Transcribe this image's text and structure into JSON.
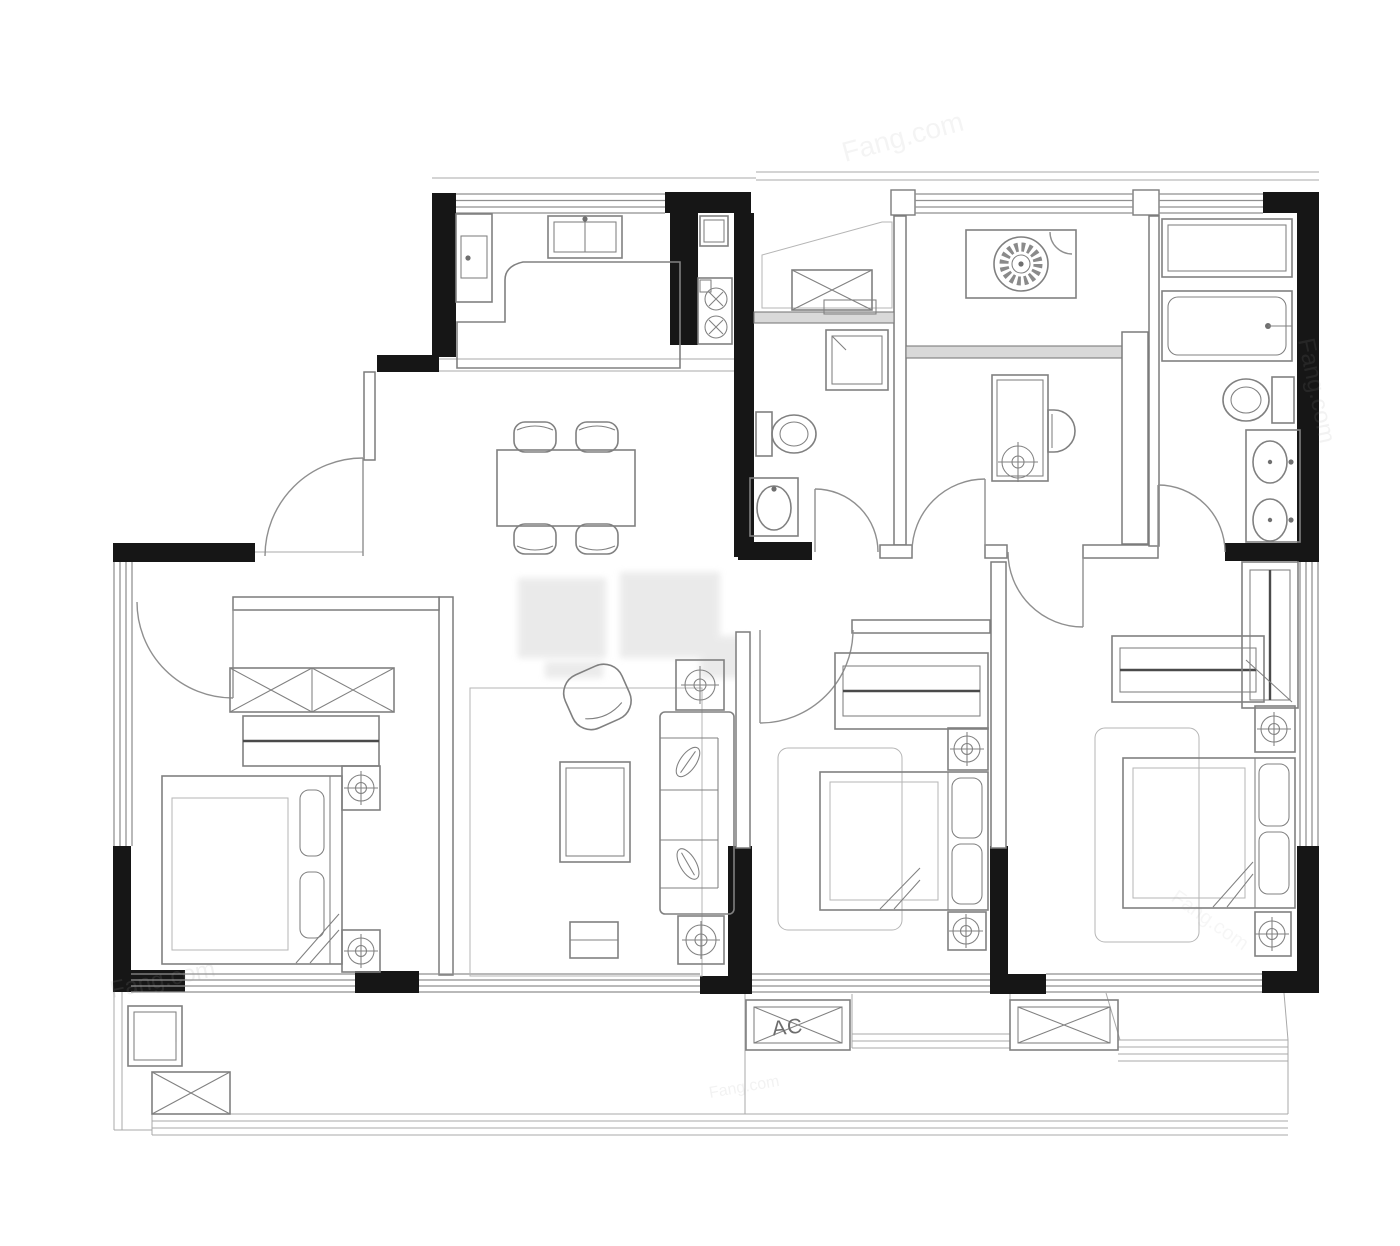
{
  "plan": {
    "ac_label": "AC",
    "watermark_text": "Fang.com",
    "colors": {
      "wall": "#161616",
      "line": "#7c7c7c",
      "furniture": "#808080",
      "window": "#8f8f8f",
      "band": "#d9d9d9",
      "watermark": "#9b9b9b",
      "background": "#ffffff"
    },
    "rooms": [
      "kitchen",
      "entry-foyer",
      "laundry-balcony",
      "study",
      "second-bathroom",
      "master-bathroom",
      "dining-hall",
      "living-room",
      "left-bedroom",
      "middle-bedroom",
      "master-bedroom",
      "south-balcony",
      "bay-window",
      "ac-platform"
    ],
    "fixtures": [
      "double-basin-sink",
      "single-sink",
      "gas-stove-two-burners",
      "refrigerator",
      "kitchen-island-counter",
      "washing-machine",
      "desk",
      "desk-chair",
      "stool",
      "shower-enclosure",
      "bathtub",
      "toilet",
      "wash-basin",
      "double-sink-vanity",
      "dining-table",
      "dining-chair",
      "shoe-cabinet",
      "duct-shaft",
      "sofa",
      "armchair",
      "coffee-table",
      "tv-cabinet",
      "side-table-plant",
      "rug",
      "double-bed",
      "pillow",
      "nightstand-with-lamp",
      "wardrobe-hanging-rail",
      "wardrobe-cabinet",
      "storage-cabinet",
      "ac-outdoor-unit",
      "entry-door-swing"
    ]
  }
}
